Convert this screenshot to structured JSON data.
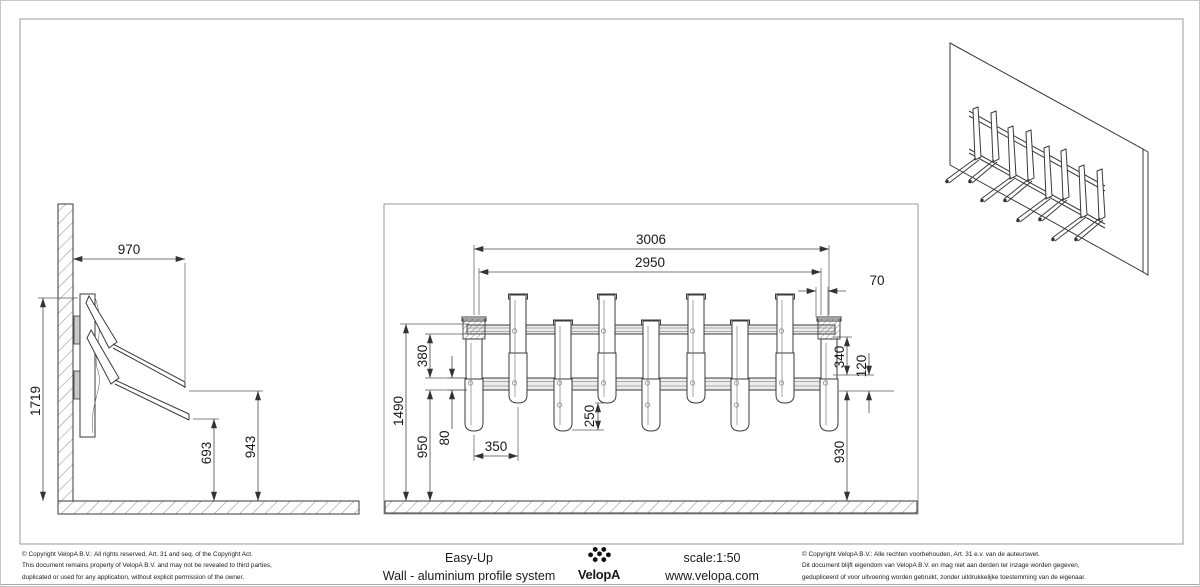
{
  "drawing": {
    "product": {
      "line1": "Easy-Up",
      "line2": "Wall - aluminium profile system"
    },
    "brand": "VelopA",
    "scale_label": "scale:1:50",
    "website": "www.velopa.com",
    "copyright_en": [
      "©  Copyright VelopA B.V.: All rights reserved, Art. 31 and seq. of the Copyright Act.",
      "This document remains property of VelopA B.V. and may not be revealed to third parties,",
      "duplicated or used for any application, without explicit permission of the owner."
    ],
    "copyright_nl": [
      "©  Copyright VelopA B.V.: Alle rechten voorbehouden, Art. 31 e.v. van de auteurswet.",
      "Dit document blijft eigendom van VelopA B.V. en mag niet aan derden ter inzage worden gegeven,",
      "gedupliceerd of voor uitvoering worden gebruikt, zonder uitdrukkelijke toestemming van de eigenaar."
    ],
    "dimensions": {
      "side_view": {
        "depth": "970",
        "total_height": "1719",
        "upper_arm_tip_height": "943",
        "lower_arm_tip_height": "693"
      },
      "front_view": {
        "overall_width": "3006",
        "mounting_width": "2950",
        "end_bracket_offset": "70",
        "total_height": "1490",
        "rail_spacing": "380",
        "lower_rail_height": "950",
        "rail_profile_height": "80",
        "hook_spacing": "350",
        "hook_drop": "250",
        "bracket_to_rail": "340",
        "rail_mount_depth": "120",
        "clearance_under_rail": "930"
      }
    },
    "colors": {
      "linework": "#3a3a3a",
      "hatch": "#8a8a8a",
      "background": "#ffffff"
    }
  }
}
